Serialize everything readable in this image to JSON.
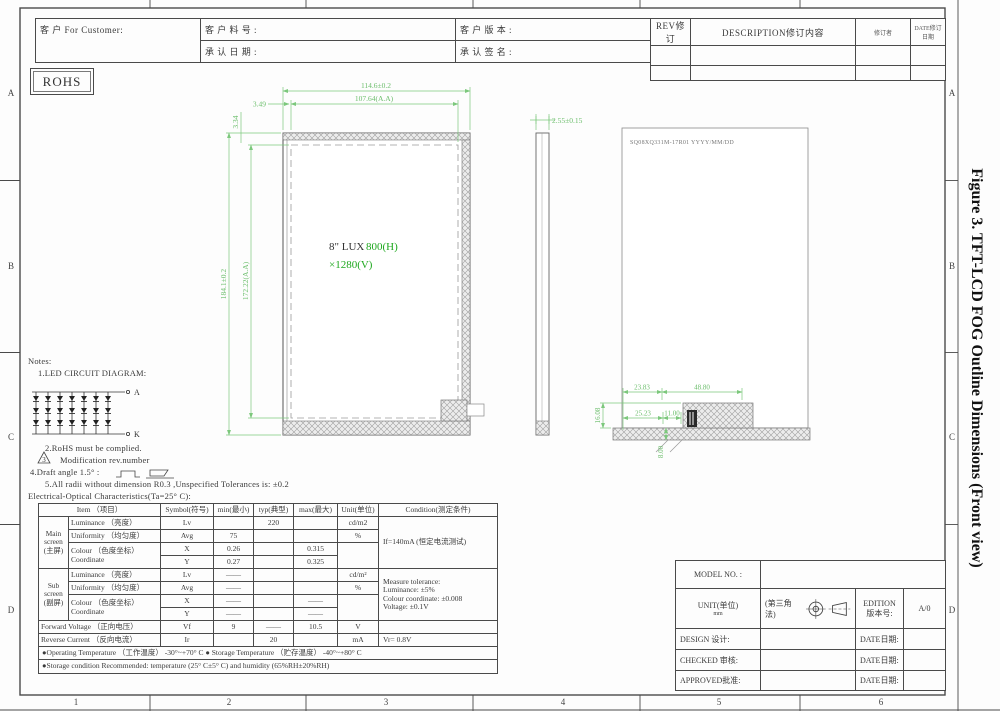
{
  "colors": {
    "dim_green": "#7cc87c",
    "res_green": "#1ea81e",
    "line_dark": "#4a4a4a",
    "hatch_gray": "#9f9f9f"
  },
  "figure_title": "Figure 3. TFT-LCD FOG Outline Dimensions (Front view)",
  "rohs": "ROHS",
  "header": {
    "customer": "客  户    For Customer:",
    "part_no": "客 户 料 号 :",
    "approve_date": "承 认 日 期 :",
    "customer_ver": "客 户 版 本 :",
    "approve_sign": "承 认 签 名 :",
    "rev": "REV修订",
    "description": "DESCRIPTION修订内容",
    "revised_by": "修订者",
    "revised_date": "DATE修订日期"
  },
  "grid": {
    "rows": [
      "A",
      "B",
      "C",
      "D"
    ],
    "cols": [
      "1",
      "2",
      "3",
      "4",
      "5",
      "6"
    ]
  },
  "front_view": {
    "dim_width": "114.6±0.2",
    "dim_width_aa": "107.64(A.A)",
    "dim_offset_x": "3.49",
    "dim_offset_y": "3.34",
    "dim_height": "184.1±0.2",
    "dim_height_aa": "172.22(A.A)",
    "label_size": "8\" LUX",
    "label_res_h": "800(H)",
    "label_res_v": "×1280(V)"
  },
  "side_view": {
    "dim_thickness": "2.55±0.15"
  },
  "back_view": {
    "label": "SQ08XQ331M-17R01    YYYY/MM/DD",
    "dim_1": "23.83",
    "dim_2": "48.80",
    "dim_3": "25.23",
    "dim_4": "11.00",
    "dim_5": "8.00",
    "dim_6": "16.08"
  },
  "notes": {
    "title": "Notes:",
    "n1": "1.LED CIRCUIT DIAGRAM:",
    "term_a": "A",
    "term_k": "K",
    "n2": "2.RoHS must be complied.",
    "n3_num": "3",
    "n3": "Modification rev.number",
    "n4": "4.Draft angle 1.5° :",
    "n5": "5.All radii without dimension R0.3   ,Unspecified Tolerances is:    ±0.2"
  },
  "eo_table": {
    "title": "Electrical-Optical Characteristics(Ta=25° C):",
    "headers": {
      "item": "Item （项目）",
      "symbol": "Symbol(符号)",
      "min": "min(最小)",
      "typ": "typ(典型)",
      "max": "max(最大)",
      "unit": "Unit(单位)",
      "condition": "Condition(测定条件)"
    },
    "main_group": "Main\nscreen\n(主屏)",
    "sub_group": "Sub\nscreen\n(副屏)",
    "colour_label": "Colour （色度坐标）\nCoordinate",
    "rows": {
      "m_lum": {
        "item": "Luminance   （亮度）",
        "sym": "Lv",
        "typ": "220",
        "unit": "cd/m2"
      },
      "m_uni": {
        "item": "Uniformity （均匀度）",
        "sym": "Avg",
        "min": "75",
        "unit": "%"
      },
      "m_x": {
        "sym": "X",
        "min": "0.26",
        "max": "0.315"
      },
      "m_y": {
        "sym": "Y",
        "min": "0.27",
        "max": "0.325"
      },
      "s_lum": {
        "item": "Luminance   （亮度）",
        "sym": "Lv",
        "min": "——",
        "unit": "cd/m²"
      },
      "s_uni": {
        "item": "Uniformity （均匀度）",
        "sym": "Avg",
        "min": "——",
        "unit": "%"
      },
      "s_x": {
        "sym": "X",
        "min": "——",
        "max": "——"
      },
      "s_y": {
        "sym": "Y",
        "min": "——",
        "max": "——"
      },
      "fwd": {
        "item": "Forward Voltage （正向电压）",
        "sym": "Vf",
        "min": "9",
        "typ": "——",
        "max": "10.5",
        "unit": "V"
      },
      "rev": {
        "item": "Reverse Current （反向电流）",
        "sym": "Ir",
        "typ": "20",
        "unit": "mA",
        "cond": "Vr= 0.8V"
      }
    },
    "cond_main": "If=140mA (恒定电流测试)",
    "cond_sub": "Measure tolerance:\nLuminance: ±5%\nColour coordinate: ±0.008\nVoltage: ±0.1V",
    "op_temp_row": "●Operating Temperature （工作温度）   -30°~+70° C     ● Storage Temperature （贮存温度）   -40°~+80° C",
    "storage_row": "●Storage condition Recommended:     temperature (25° C±5° C) and humidity (65%RH±20%RH)"
  },
  "title_block": {
    "model": "MODEL NO. :",
    "unit_label": "UNIT(单位)",
    "unit_value": "mm",
    "angle_label": "(第三角法)",
    "edition_label": "EDITION\n版本号:",
    "edition_value": "A/0",
    "design": "DESIGN  设计:",
    "checked": "CHECKED 审核:",
    "approved": "APPROVED批准:",
    "date": "DATE日期:"
  }
}
